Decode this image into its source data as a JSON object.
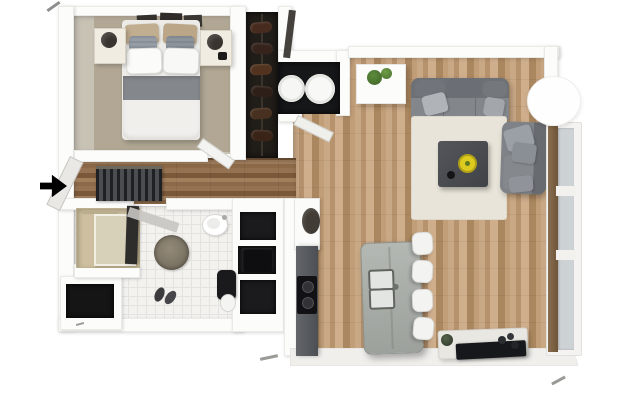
{
  "meta": {
    "view": "top-down 3D floor plan render",
    "unit_type": "one-bedroom apartment",
    "width_px": 640,
    "height_px": 415
  },
  "palette": {
    "background": "#ffffff",
    "walls": "#fcfcfa",
    "wood_living": "#bf9e7b",
    "wood_hall": "#8c6a49",
    "bedroom_carpet": "#b1a794",
    "bath_tile": "#f3f2ef",
    "sofa_gray": "#83868b",
    "rug_cream": "#e8e4d9",
    "island_concrete": "#aab0aa",
    "counter_dark": "#55585c",
    "accent_yellow": "#ddca1e",
    "dark_fixture": "#1a1a1c",
    "window_glass": "#cdd2d5",
    "window_wood": "#8a6e50"
  },
  "rooms": {
    "bedroom": {
      "label": "Bedroom",
      "floor": "taupe carpet",
      "furniture": [
        "double bed with white duvet",
        "gray throw band",
        "white pillows",
        "tan and gray accent pillows",
        "dark wall art above headboard",
        "left nightstand with round lamp",
        "right nightstand with round lamp and dark item",
        "open swing door"
      ]
    },
    "closet": {
      "label": "Wardrobe closet",
      "furniture": [
        "dark shoe shelf column",
        "leaning door panel"
      ]
    },
    "laundry_nook": {
      "label": "Laundry nook",
      "furniture": [
        "washer (white round top)",
        "dryer (white round top)",
        "open door"
      ]
    },
    "hallway": {
      "label": "Entry hallway",
      "floor": "dark wood planks",
      "furniture": [
        "dark slatted radiator",
        "leaning entry door"
      ],
      "entry_marker": "black arrow pointing right at entrance"
    },
    "bathroom": {
      "label": "Bathroom",
      "floor": "white square tile",
      "furniture": [
        "walk-in shower with beige tile and glass door",
        "dark open door",
        "round shaggy rug",
        "oval white washbasin",
        "black toilet",
        "pair of slippers",
        "three dark wall niches (one with black washer box)",
        "dark storage niche bottom-left"
      ]
    },
    "kitchen": {
      "label": "Kitchen",
      "furniture": [
        "tall white cabinet",
        "dark wall basin",
        "dark counter with black two-burner cooktop",
        "concrete island with double sink and faucet",
        "four white bar stools"
      ]
    },
    "living_room": {
      "label": "Living room",
      "floor": "light oak planks",
      "furniture": [
        "white side table with two green plants",
        "gray three-seat sofa with light pillows",
        "cream area rug",
        "dark square coffee table with yellow bowl and black dish",
        "gray lounge chair with pillows",
        "white media console with flat TV, plant and gadgets",
        "round white paper floor lamp",
        "french window with wood frame"
      ]
    }
  }
}
